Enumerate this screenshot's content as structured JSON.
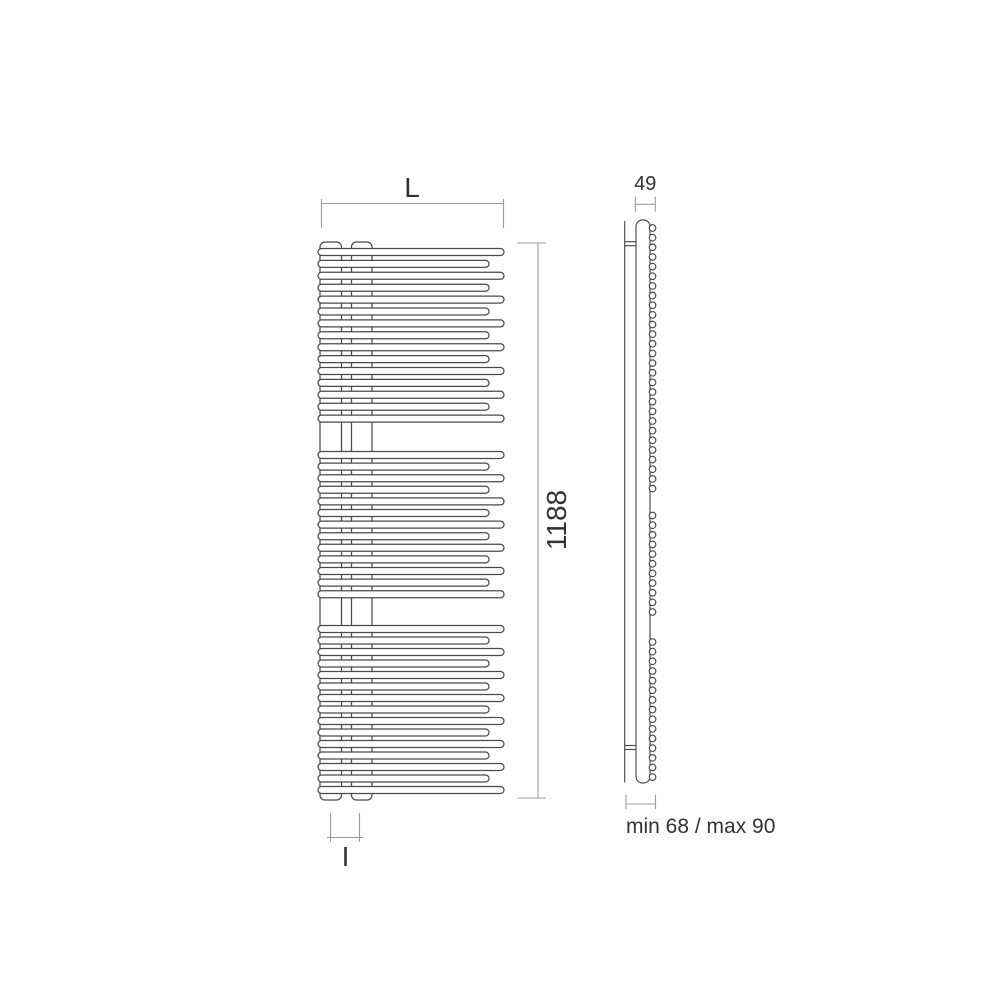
{
  "diagram": {
    "type": "technical-drawing",
    "subject": "towel-radiator-dimension-drawing",
    "canvas": {
      "width": 1000,
      "height": 1000,
      "background": "#ffffff"
    },
    "colors": {
      "line": "#4a4a4a",
      "dim_line": "#9c9c9c",
      "text": "#333333",
      "fill": "#ffffff"
    },
    "labels": {
      "width": "L",
      "height": "1188",
      "interaxis": "I",
      "depth": "49",
      "wall_distance": "min 68 / max 90"
    },
    "front_view": {
      "tube_left_x": 318,
      "tube_long_right_x": 504,
      "tube_short_right_x": 489,
      "tube_height": 7,
      "collectors": [
        {
          "x": 320.0,
          "y": 242,
          "w": 21.5,
          "h": 558,
          "rx": 5
        },
        {
          "x": 351.5,
          "y": 242,
          "w": 20.5,
          "h": 558,
          "rx": 5
        }
      ],
      "tube_groups": [
        {
          "count": 15,
          "first_y": 252,
          "pitch": 11.9
        },
        {
          "count": 13,
          "first_y": 455,
          "pitch": 11.6
        },
        {
          "count": 15,
          "first_y": 629,
          "pitch": 11.5
        }
      ]
    },
    "side_view": {
      "wall_line": {
        "x": 624.7,
        "y1": 221,
        "y2": 782.5
      },
      "panel": {
        "x": 636,
        "y": 220,
        "w": 14,
        "h": 563,
        "rx": 6.5
      },
      "brackets": [
        {
          "x1": 624.7,
          "x2": 636,
          "y": 241.7
        },
        {
          "x1": 624.7,
          "x2": 636,
          "y": 245.7
        },
        {
          "x1": 624.7,
          "x2": 636,
          "y": 745.5
        },
        {
          "x1": 624.7,
          "x2": 636,
          "y": 749.5
        }
      ],
      "circle_cx": 652.5,
      "circle_r": 3.3,
      "circle_groups": [
        {
          "count": 28,
          "first_y": 228.0,
          "pitch": 9.65
        },
        {
          "count": 11,
          "first_y": 515.5,
          "pitch": 9.65
        },
        {
          "count": 15,
          "first_y": 642.0,
          "pitch": 9.65
        }
      ]
    },
    "dimensions": [
      {
        "id": "width",
        "label": "L",
        "type": "h",
        "x1": 321.5,
        "x2": 503.5,
        "y": 203.5,
        "tick_y1": 199,
        "tick_y2": 228,
        "label_x": 412,
        "label_y": 197,
        "font": 28
      },
      {
        "id": "height",
        "label": "1188",
        "type": "v",
        "x": 538,
        "y1": 243,
        "y2": 798,
        "tick_x1": 517,
        "tick_x2": 546,
        "label_x": 566,
        "label_y": 520,
        "font": 28,
        "rotate": -90
      },
      {
        "id": "interaxis",
        "label": "I",
        "type": "h",
        "x1": 330.5,
        "x2": 359.5,
        "y": 837.5,
        "tick_y1": 813,
        "tick_y2": 842,
        "line_overhang": 3.5,
        "label_x": 345.5,
        "label_y": 866,
        "font": 28
      },
      {
        "id": "depth",
        "label": "49",
        "type": "h",
        "x1": 635.3,
        "x2": 655.3,
        "y": 204.3,
        "tick_y1": 196.7,
        "tick_y2": 211.7,
        "label_x": 645.3,
        "label_y": 190,
        "font": 20
      },
      {
        "id": "wall-distance",
        "label": "min 68 / max 90",
        "type": "h",
        "x1": 626,
        "x2": 655.5,
        "y": 804,
        "tick_y1": 795,
        "tick_y2": 809,
        "label_x": 626,
        "label_y": 833,
        "font": 21,
        "anchor": "start"
      }
    ]
  }
}
